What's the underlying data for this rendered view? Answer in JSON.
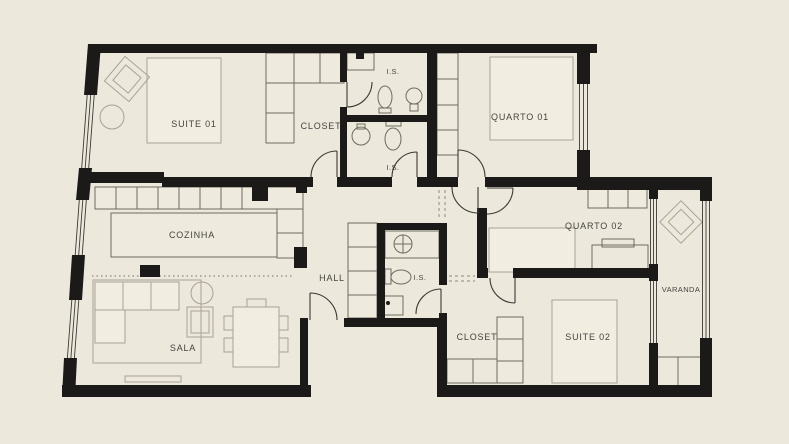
{
  "colors": {
    "background": "#ece8db",
    "wall": "#1b1a18",
    "furniture_light": "#a8a294",
    "furniture_dark": "#6e6b61",
    "label_text": "#454440"
  },
  "rooms": {
    "suite01": {
      "label": "SUITE 01"
    },
    "closet01": {
      "label": "CLOSET"
    },
    "is1": {
      "label": "I.S."
    },
    "is2": {
      "label": "I.S."
    },
    "quarto01": {
      "label": "QUARTO 01"
    },
    "cozinha": {
      "label": "COZINHA"
    },
    "hall": {
      "label": "HALL"
    },
    "is3": {
      "label": "I.S."
    },
    "quarto02": {
      "label": "QUARTO 02"
    },
    "varanda": {
      "label": "VARANDA"
    },
    "sala": {
      "label": "SALA"
    },
    "closet02": {
      "label": "CLOSET"
    },
    "suite02": {
      "label": "SUITE 02"
    }
  }
}
